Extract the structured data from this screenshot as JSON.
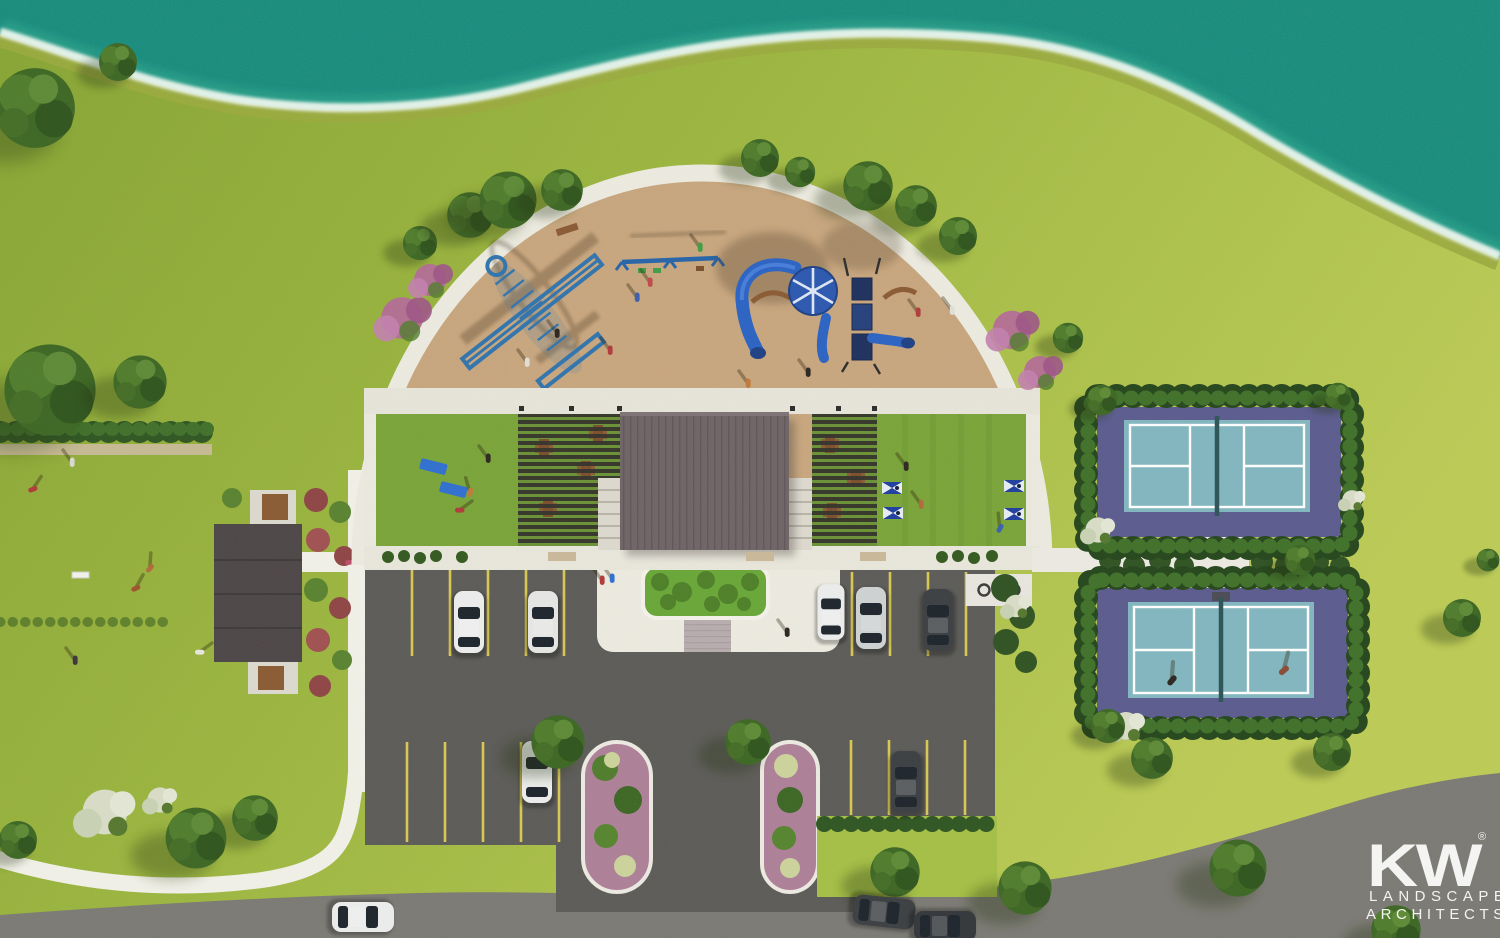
{
  "canvas": {
    "width": 1500,
    "height": 938
  },
  "logo": {
    "mark": "KW",
    "registered": "®",
    "line1": "LANDSCAPE",
    "line2": "ARCHITECTS"
  },
  "colors": {
    "water": "#0f8a7c",
    "foam": "#eef8f0",
    "shore_band": "#9aaa3e",
    "grass_dark": "#87a434",
    "grass_light": "#bccb55",
    "lawn_panel": "#79a438",
    "playground_surface": "#c9a47b",
    "concrete": "#edebe1",
    "paver": "#b7acae",
    "asphalt": "#5b5a57",
    "road": "#7b7974",
    "stall_stripe": "#d9c751",
    "pavilion_roof": "#6e6366",
    "pergola_slat": "#32302a",
    "building_roof": "#4c4547",
    "court_apron": "#5a5a8e",
    "court_surface": "#81b6c0",
    "court_line": "#ffffff",
    "net": "#2b5356",
    "hedge": "#2e5522",
    "tree_green": "#3c6623",
    "pink_shrub": "#b5679a",
    "white_shrub": "#d9ddc7",
    "planter_green": "#68a637",
    "table_brown": "#8a5a33",
    "yoga_mat": "#2f6fd0",
    "cornhole_board": "#1e3e9f",
    "car_white": "#eceded",
    "car_silver": "#cfd2d4",
    "car_dark": "#3b3e42",
    "logo_text": "#f4f4f2"
  },
  "features": {
    "lake": 1,
    "playground": 1,
    "airplane_climber": 1,
    "swing_set": 1,
    "play_structure": 1,
    "shade_canopy": 1,
    "tube_slides": 3,
    "pavilion": 1,
    "pergolas": 2,
    "picnic_tables": 8,
    "yoga_mats": 2,
    "cornhole_boards": 4,
    "pickleball_courts": 2,
    "players_on_court": 2,
    "restroom_building": 1,
    "benches": 2,
    "entry_plaza": 1,
    "plaza_planter": 1,
    "parking_islands": 2,
    "bike_racks": 3,
    "cars_parked": 7,
    "cars_on_road": 3
  }
}
